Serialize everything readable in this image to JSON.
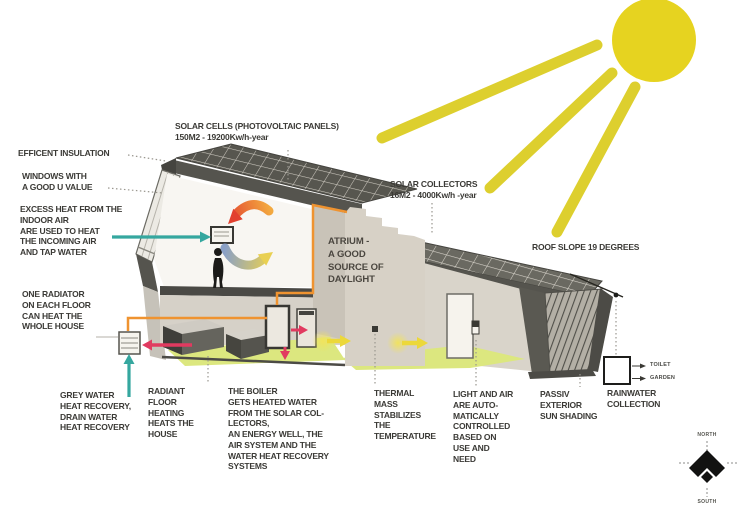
{
  "figure": {
    "type": "eco-house energy concept section diagram",
    "callouts": {
      "solar_cells": "SOLAR CELLS (PHOTOVOLTAIC PANELS)\n150M2 - 19200Kw/h-year",
      "solar_collectors": "SOLAR COLLECTORS\n16M2 - 4000Kw/h -year",
      "roof_slope": "ROOF SLOPE 19 DEGREES",
      "efficient_insulation": "EFFICENT INSULATION",
      "windows": "WINDOWS WITH\nA GOOD U VALUE",
      "excess_heat": "EXCESS HEAT FROM THE\nINDOOR AIR\nARE USED TO HEAT\nTHE INCOMING AIR\nAND TAP WATER",
      "one_radiator": "ONE RADIATOR\nON EACH FLOOR\nCAN HEAT THE\nWHOLE HOUSE",
      "grey_water": "GREY WATER\nHEAT RECOVERY,\nDRAIN WATER\nHEAT RECOVERY",
      "radiant_floor": "RADIANT\nFLOOR\nHEATING\nHEATS THE\nHOUSE",
      "boiler": "THE BOILER\nGETS HEATED WATER\nFROM THE SOLAR COL-\nLECTORS,\nAN ENERGY WELL, THE\nAIR SYSTEM AND THE\nWATER HEAT RECOVERY\nSYSTEMS",
      "thermal_mass": "THERMAL\nMASS\nSTABILIZES\nTHE\nTEMPERATURE",
      "light_air": "LIGHT AND AIR\nARE AUTO-\nMATICALLY\nCONTROLLED\nBASED ON\nUSE AND\nNEED",
      "passive_shading": "PASSIV\nEXTERIOR\nSUN SHADING",
      "rainwater": "RAINWATER\nCOLLECTION",
      "atrium": "ATRIUM -\nA GOOD\nSOURCE OF\nDAYLIGHT",
      "toilet": "TOILET",
      "garden": "GARDEN",
      "north": "NORTH",
      "south": "SOUTH"
    },
    "colors": {
      "sun": "#e6d320",
      "teal_arrow": "#35a79f",
      "pink_arrow": "#e13a60",
      "orange_pipe": "#ef9330",
      "yellow_arrow": "#ecd83a",
      "floor_green": "#dce77f",
      "roof_gray": "#55544e",
      "text": "#3b3a36"
    }
  }
}
